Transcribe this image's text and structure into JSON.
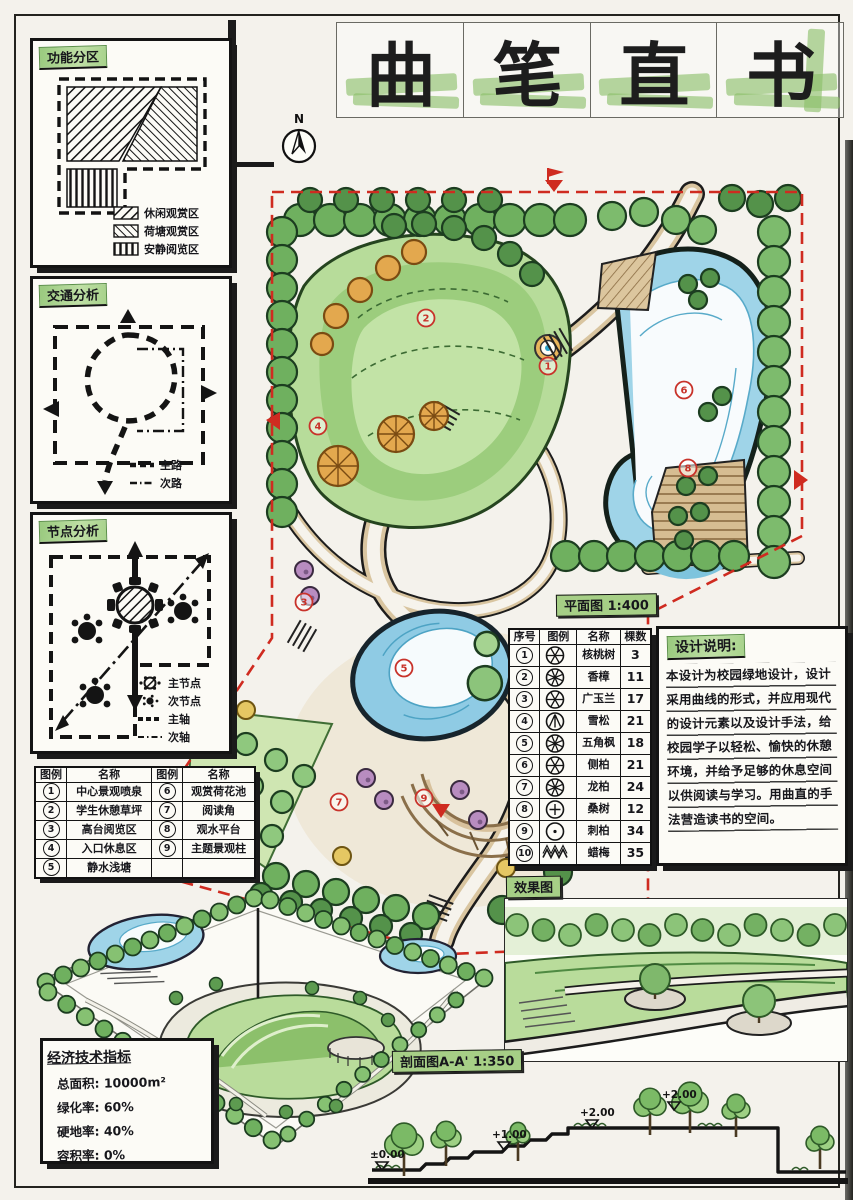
{
  "sheet": {
    "title_chars": [
      "曲",
      "笔",
      "直",
      "书"
    ],
    "compass_label": "N"
  },
  "analysis": {
    "function": {
      "title": "功能分区",
      "legend": [
        {
          "pattern": "hatch-ne",
          "label": "休闲观赏区"
        },
        {
          "pattern": "hatch-nw",
          "label": "荷塘观赏区"
        },
        {
          "pattern": "hatch-v",
          "label": "安静阅览区"
        }
      ]
    },
    "traffic": {
      "title": "交通分析",
      "legend": [
        {
          "style": "dash-bold",
          "label": "主路"
        },
        {
          "style": "dash-dot",
          "label": "次路"
        }
      ]
    },
    "nodes": {
      "title": "节点分析",
      "legend": [
        {
          "style": "main-node",
          "label": "主节点"
        },
        {
          "style": "sub-node",
          "label": "次节点"
        },
        {
          "style": "axis-main",
          "label": "主轴"
        },
        {
          "style": "axis-sub",
          "label": "次轴"
        }
      ]
    }
  },
  "legend_table": {
    "headers": [
      "图例",
      "名称",
      "图例",
      "名称"
    ],
    "rows": [
      [
        "1",
        "中心景观喷泉",
        "6",
        "观赏荷花池"
      ],
      [
        "2",
        "学生休憩草坪",
        "7",
        "阅读角"
      ],
      [
        "3",
        "高台阅览区",
        "8",
        "观水平台"
      ],
      [
        "4",
        "入口休息区",
        "9",
        "主题景观柱"
      ],
      [
        "5",
        "静水浅塘",
        "",
        ""
      ]
    ]
  },
  "plant_table": {
    "headers": [
      "序号",
      "图例",
      "名称",
      "棵数"
    ],
    "rows": [
      {
        "no": "1",
        "symbol": "seg",
        "name": "核桃树",
        "count": "3"
      },
      {
        "no": "2",
        "symbol": "seg2",
        "name": "香樟",
        "count": "11"
      },
      {
        "no": "3",
        "symbol": "seg",
        "name": "广玉兰",
        "count": "17"
      },
      {
        "no": "4",
        "symbol": "cedar",
        "name": "雪松",
        "count": "21"
      },
      {
        "no": "5",
        "symbol": "seg2",
        "name": "五角枫",
        "count": "18"
      },
      {
        "no": "6",
        "symbol": "seg",
        "name": "侧柏",
        "count": "21"
      },
      {
        "no": "7",
        "symbol": "seg2",
        "name": "龙柏",
        "count": "24"
      },
      {
        "no": "8",
        "symbol": "cross",
        "name": "桑树",
        "count": "12"
      },
      {
        "no": "9",
        "symbol": "dot",
        "name": "刺柏",
        "count": "34"
      },
      {
        "no": "10",
        "symbol": "hedge",
        "name": "蜡梅",
        "count": "35"
      }
    ]
  },
  "design_notes": {
    "title": "设计说明:",
    "body": "本设计为校园绿地设计，设计采用曲线的形式，并应用现代的设计元素以及设计手法，给校园学子以轻松、愉快的休憩环境，并给予足够的休息空间以供阅读与学习。用曲直的手法营造读书的空间。"
  },
  "labels": {
    "plan": "平面图 1:400",
    "render": "效果图",
    "section": "剖面图A-A' 1:350"
  },
  "econ": {
    "title": "经济技术指标",
    "items": [
      {
        "k": "总面积",
        "v": "10000m²"
      },
      {
        "k": "绿化率",
        "v": "60%"
      },
      {
        "k": "硬地率",
        "v": "40%"
      },
      {
        "k": "容积率",
        "v": "0%"
      }
    ]
  },
  "section_marks": [
    "±0.00",
    "+1.00",
    "+2.00",
    "+2.00"
  ],
  "plan_markers": [
    {
      "n": "1",
      "x": 452,
      "y": 198
    },
    {
      "n": "2",
      "x": 330,
      "y": 150
    },
    {
      "n": "3",
      "x": 208,
      "y": 434
    },
    {
      "n": "4",
      "x": 222,
      "y": 258
    },
    {
      "n": "5",
      "x": 308,
      "y": 500
    },
    {
      "n": "6",
      "x": 588,
      "y": 222
    },
    {
      "n": "7",
      "x": 243,
      "y": 634
    },
    {
      "n": "8",
      "x": 592,
      "y": 300
    },
    {
      "n": "9",
      "x": 328,
      "y": 630
    }
  ]
}
